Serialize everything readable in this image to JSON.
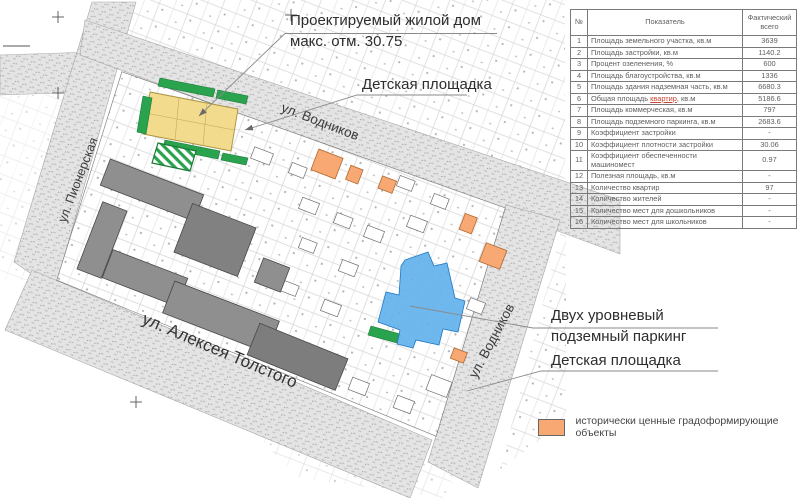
{
  "map": {
    "streets": {
      "pionerskaya": "ул. Пионерская",
      "vodnikov_top": "ул. Водников",
      "vodnikov_right": "ул. Водников",
      "tolstogo": "ул. Алексея Толстого"
    },
    "annotations": {
      "proposed_building": {
        "line1": "Проектируемый жилой дом",
        "line2": "макс. отм. 30.75"
      },
      "playground_top": "Детская площадка",
      "parking": {
        "line1": "Двух уровневый",
        "line2": "подземный паркинг"
      },
      "playground_bottom": "Детская площадка"
    },
    "colors": {
      "proposed_building": "#f2db8d",
      "landscaping": "#2aa34f",
      "underground_parking": "#5fb0ec",
      "historic_object": "#f7a873",
      "street": "#e4e4e4",
      "building_gray": "#8f8f8f"
    }
  },
  "legend": {
    "swatch_color": "#f7a873",
    "label": "исторически ценные градоформирующие объекты"
  },
  "table": {
    "headers": {
      "num": "№",
      "indicator": "Показатель",
      "actual": "Фактический всего"
    },
    "rows": [
      {
        "num": "1",
        "label": "Площадь земельного участка, кв.м",
        "value": "3639"
      },
      {
        "num": "2",
        "label": "Площадь застройки, кв.м",
        "value": "1140.2"
      },
      {
        "num": "3",
        "label": "Процент озеленения, %",
        "value": "600"
      },
      {
        "num": "4",
        "label": "Площадь благоустройства, кв.м",
        "value": "1336"
      },
      {
        "num": "5",
        "label": "Площадь здания надземная часть, кв.м",
        "value": "6680.3"
      },
      {
        "num": "6",
        "label": "Общая площадь квартир, кв.м",
        "underline_word": "квартир",
        "value": "5186.6"
      },
      {
        "num": "7",
        "label": "Площадь коммерческая, кв.м",
        "value": "797"
      },
      {
        "num": "8",
        "label": "Площадь подземного паркинга, кв.м",
        "value": "2683.6"
      },
      {
        "num": "9",
        "label": "Коэффициент застройки",
        "value": "-"
      },
      {
        "num": "10",
        "label": "Коэффициент плотности застройки",
        "value": "30.06"
      },
      {
        "num": "11",
        "label": "Коэффициент обеспеченности машиномест",
        "value": "0.97"
      },
      {
        "num": "12",
        "label": "Полезная площадь, кв.м",
        "value": "-"
      },
      {
        "num": "13",
        "label": "Количество квартир",
        "value": "97"
      },
      {
        "num": "14",
        "label": "Количество жителей",
        "value": "-"
      },
      {
        "num": "15",
        "label": "Количество мест для дошкольников",
        "value": "-"
      },
      {
        "num": "16",
        "label": "Количество мест для школьников",
        "value": "-"
      }
    ]
  }
}
